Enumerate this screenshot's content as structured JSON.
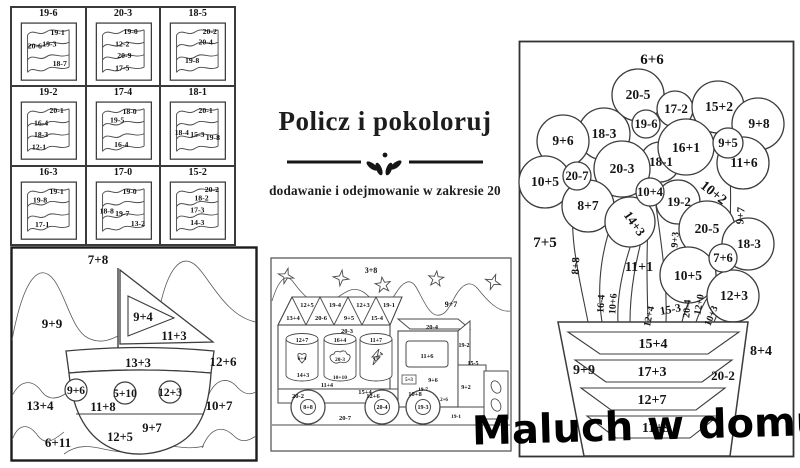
{
  "title_block": {
    "title": "Policz i pokoloruj",
    "subtitle": "dodawanie i odejmowanie w zakresie 20"
  },
  "watermark": {
    "text": "Maluch w domu"
  },
  "colors": {
    "ink": "#141414",
    "line": "#474747",
    "background": "#ffffff"
  },
  "flags_grid": {
    "cells": [
      {
        "header": "19-6",
        "labels": [
          {
            "t": "19-1",
            "x": 44,
            "y": 13
          },
          {
            "t": "20-6",
            "x": 22,
            "y": 26
          },
          {
            "t": "19-3",
            "x": 36,
            "y": 24
          },
          {
            "t": "18-7",
            "x": 46,
            "y": 43
          }
        ]
      },
      {
        "header": "20-3",
        "labels": [
          {
            "t": "19-0",
            "x": 42,
            "y": 12
          },
          {
            "t": "12-2",
            "x": 34,
            "y": 24
          },
          {
            "t": "20-9",
            "x": 36,
            "y": 35
          },
          {
            "t": "17-5",
            "x": 34,
            "y": 47
          }
        ]
      },
      {
        "header": "18-5",
        "labels": [
          {
            "t": "20-2",
            "x": 47,
            "y": 12
          },
          {
            "t": "20-4",
            "x": 43,
            "y": 22
          },
          {
            "t": "19-8",
            "x": 30,
            "y": 40
          }
        ]
      },
      {
        "header": "19-2",
        "labels": [
          {
            "t": "20-1",
            "x": 43,
            "y": 12
          },
          {
            "t": "16-4",
            "x": 28,
            "y": 24
          },
          {
            "t": "18-3",
            "x": 28,
            "y": 35
          },
          {
            "t": "12-1",
            "x": 26,
            "y": 47
          }
        ]
      },
      {
        "header": "17-4",
        "labels": [
          {
            "t": "18-0",
            "x": 41,
            "y": 13
          },
          {
            "t": "19-5",
            "x": 29,
            "y": 21
          },
          {
            "t": "16-4",
            "x": 33,
            "y": 45
          }
        ]
      },
      {
        "header": "18-1",
        "labels": [
          {
            "t": "20-1",
            "x": 43,
            "y": 12
          },
          {
            "t": "18-4",
            "x": 20,
            "y": 33
          },
          {
            "t": "15-3",
            "x": 35,
            "y": 35
          },
          {
            "t": "19-8",
            "x": 50,
            "y": 38
          }
        ]
      },
      {
        "header": "16-3",
        "labels": [
          {
            "t": "19-1",
            "x": 43,
            "y": 13
          },
          {
            "t": "19-8",
            "x": 27,
            "y": 21
          },
          {
            "t": "17-1",
            "x": 29,
            "y": 45
          }
        ]
      },
      {
        "header": "17-0",
        "labels": [
          {
            "t": "19-0",
            "x": 41,
            "y": 13
          },
          {
            "t": "18-8",
            "x": 19,
            "y": 32
          },
          {
            "t": "19-7",
            "x": 34,
            "y": 34
          },
          {
            "t": "13-2",
            "x": 49,
            "y": 44
          }
        ]
      },
      {
        "header": "15-2",
        "labels": [
          {
            "t": "20-2",
            "x": 49,
            "y": 11
          },
          {
            "t": "18-2",
            "x": 39,
            "y": 19
          },
          {
            "t": "17-3",
            "x": 35,
            "y": 31
          },
          {
            "t": "14-3",
            "x": 35,
            "y": 43
          }
        ]
      }
    ]
  },
  "boat": {
    "labels": [
      {
        "t": "7+8",
        "x": 88,
        "y": 18,
        "s": 13
      },
      {
        "t": "9+9",
        "x": 42,
        "y": 82,
        "s": 13
      },
      {
        "t": "9+4",
        "x": 133,
        "y": 75,
        "s": 12.5
      },
      {
        "t": "11+3",
        "x": 164,
        "y": 94,
        "s": 12.5
      },
      {
        "t": "12+6",
        "x": 213,
        "y": 120,
        "s": 13
      },
      {
        "t": "13+3",
        "x": 128,
        "y": 121,
        "s": 12.5
      },
      {
        "t": "9+6",
        "x": 66,
        "y": 148,
        "s": 11.5
      },
      {
        "t": "5+10",
        "x": 115,
        "y": 151,
        "s": 11.5
      },
      {
        "t": "12+3",
        "x": 160,
        "y": 150,
        "s": 11.5
      },
      {
        "t": "13+4",
        "x": 30,
        "y": 164,
        "s": 13
      },
      {
        "t": "10+7",
        "x": 209,
        "y": 164,
        "s": 13
      },
      {
        "t": "11+8",
        "x": 93,
        "y": 165,
        "s": 12.5
      },
      {
        "t": "9+7",
        "x": 142,
        "y": 186,
        "s": 12.5
      },
      {
        "t": "12+5",
        "x": 110,
        "y": 195,
        "s": 12.5
      },
      {
        "t": "6+11",
        "x": 48,
        "y": 201,
        "s": 13
      }
    ]
  },
  "truck": {
    "labels": [
      {
        "t": "3+8",
        "x": 101,
        "y": 16,
        "s": 8
      },
      {
        "t": "9+7",
        "x": 181,
        "y": 50,
        "s": 8
      },
      {
        "t": "13+4",
        "x": 23,
        "y": 63,
        "s": 6.5
      },
      {
        "t": "20-6",
        "x": 51,
        "y": 63,
        "s": 6.5
      },
      {
        "t": "9+5",
        "x": 79,
        "y": 63,
        "s": 6.5
      },
      {
        "t": "15-4",
        "x": 107,
        "y": 63,
        "s": 6.5
      },
      {
        "t": "12+5",
        "x": 37,
        "y": 50,
        "s": 6.5
      },
      {
        "t": "19-4",
        "x": 65,
        "y": 50,
        "s": 6.5
      },
      {
        "t": "12+3",
        "x": 93,
        "y": 50,
        "s": 6.5
      },
      {
        "t": "19-1",
        "x": 119,
        "y": 50,
        "s": 6.5
      },
      {
        "t": "20-3",
        "x": 77,
        "y": 76,
        "s": 6.5
      },
      {
        "t": "12+7",
        "x": 32,
        "y": 85,
        "s": 6
      },
      {
        "t": "16+4",
        "x": 70,
        "y": 85,
        "s": 6
      },
      {
        "t": "11+7",
        "x": 106,
        "y": 85,
        "s": 6
      },
      {
        "t": "6+4",
        "x": 32,
        "y": 103,
        "s": 5.5
      },
      {
        "t": "20-3",
        "x": 70,
        "y": 104,
        "s": 5.5
      },
      {
        "t": "12+4",
        "x": 109,
        "y": 101,
        "s": 5.5,
        "r": -40
      },
      {
        "t": "14+3",
        "x": 33,
        "y": 120,
        "s": 6
      },
      {
        "t": "10+10",
        "x": 70,
        "y": 122,
        "s": 5.5
      },
      {
        "t": "15+4",
        "x": 95,
        "y": 137,
        "s": 6.5
      },
      {
        "t": "11+4",
        "x": 57,
        "y": 130,
        "s": 6
      },
      {
        "t": "20-2",
        "x": 28,
        "y": 141,
        "s": 6.5
      },
      {
        "t": "8+8",
        "x": 38,
        "y": 152,
        "s": 6
      },
      {
        "t": "12+6",
        "x": 103,
        "y": 141,
        "s": 6.5
      },
      {
        "t": "20-4",
        "x": 112,
        "y": 152,
        "s": 6
      },
      {
        "t": "20-7",
        "x": 75,
        "y": 163,
        "s": 6.5
      },
      {
        "t": "10+8",
        "x": 145,
        "y": 139,
        "s": 6.5
      },
      {
        "t": "19-3",
        "x": 153,
        "y": 152,
        "s": 6
      },
      {
        "t": "20-4",
        "x": 162,
        "y": 72,
        "s": 6.5
      },
      {
        "t": "11+6",
        "x": 157,
        "y": 101,
        "s": 6.5
      },
      {
        "t": "5+3",
        "x": 139,
        "y": 124,
        "s": 5
      },
      {
        "t": "9+6",
        "x": 163,
        "y": 125,
        "s": 6
      },
      {
        "t": "19-7",
        "x": 153,
        "y": 134,
        "s": 5.5
      },
      {
        "t": "19-2",
        "x": 194,
        "y": 90,
        "s": 6
      },
      {
        "t": "15-5",
        "x": 203,
        "y": 108,
        "s": 6
      },
      {
        "t": "9+2",
        "x": 196,
        "y": 132,
        "s": 6
      },
      {
        "t": "2+6",
        "x": 174,
        "y": 144,
        "s": 5
      },
      {
        "t": "19-1",
        "x": 186,
        "y": 161,
        "s": 5.5
      }
    ]
  },
  "flower": {
    "labels": [
      {
        "t": "6+6",
        "x": 134,
        "y": 24,
        "s": 15
      },
      {
        "t": "20-5",
        "x": 120,
        "y": 59,
        "s": 13.5
      },
      {
        "t": "17-2",
        "x": 158,
        "y": 73,
        "s": 13
      },
      {
        "t": "15+2",
        "x": 201,
        "y": 71,
        "s": 13.5
      },
      {
        "t": "9+8",
        "x": 241,
        "y": 88,
        "s": 13.5
      },
      {
        "t": "18-3",
        "x": 86,
        "y": 98,
        "s": 13.5
      },
      {
        "t": "19-6",
        "x": 128,
        "y": 88,
        "s": 12.5
      },
      {
        "t": "16+1",
        "x": 168,
        "y": 112,
        "s": 13.5
      },
      {
        "t": "9+5",
        "x": 210,
        "y": 107,
        "s": 12.5
      },
      {
        "t": "9+6",
        "x": 45,
        "y": 105,
        "s": 13.5
      },
      {
        "t": "11+6",
        "x": 226,
        "y": 127,
        "s": 13.5
      },
      {
        "t": "18-1",
        "x": 143,
        "y": 126,
        "s": 13
      },
      {
        "t": "20-7",
        "x": 59,
        "y": 140,
        "s": 12.5
      },
      {
        "t": "20-3",
        "x": 104,
        "y": 133,
        "s": 13.5
      },
      {
        "t": "10+5",
        "x": 27,
        "y": 146,
        "s": 13.5
      },
      {
        "t": "10+4",
        "x": 132,
        "y": 156,
        "s": 12.5
      },
      {
        "t": "19-2",
        "x": 161,
        "y": 166,
        "s": 13
      },
      {
        "t": "10+2",
        "x": 193,
        "y": 156,
        "s": 14,
        "r": 38
      },
      {
        "t": "8+7",
        "x": 70,
        "y": 170,
        "s": 13.5
      },
      {
        "t": "14+3",
        "x": 113,
        "y": 186,
        "s": 13,
        "r": 55
      },
      {
        "t": "9+7",
        "x": 226,
        "y": 176,
        "s": 11,
        "r": -85
      },
      {
        "t": "20-5",
        "x": 189,
        "y": 193,
        "s": 13.5
      },
      {
        "t": "7+5",
        "x": 27,
        "y": 207,
        "s": 15
      },
      {
        "t": "18-3",
        "x": 231,
        "y": 208,
        "s": 13
      },
      {
        "t": "7+6",
        "x": 205,
        "y": 222,
        "s": 12.5
      },
      {
        "t": "11+1",
        "x": 121,
        "y": 231,
        "s": 14
      },
      {
        "t": "8+8",
        "x": 61,
        "y": 226,
        "s": 11,
        "r": -88
      },
      {
        "t": "10+5",
        "x": 170,
        "y": 240,
        "s": 13.5
      },
      {
        "t": "12+3",
        "x": 216,
        "y": 260,
        "s": 13.5
      },
      {
        "t": "9+3",
        "x": 160,
        "y": 200,
        "s": 10,
        "r": -85
      },
      {
        "t": "16-4",
        "x": 86,
        "y": 264,
        "s": 10,
        "r": -86
      },
      {
        "t": "10+6",
        "x": 98,
        "y": 264,
        "s": 10,
        "r": -86
      },
      {
        "t": "12+4",
        "x": 134,
        "y": 277,
        "s": 10,
        "r": -78
      },
      {
        "t": "15-3",
        "x": 153,
        "y": 273,
        "s": 11.5,
        "r": -10
      },
      {
        "t": "20-4",
        "x": 172,
        "y": 269,
        "s": 10,
        "r": -85
      },
      {
        "t": "12+0",
        "x": 184,
        "y": 265,
        "s": 10,
        "r": -80
      },
      {
        "t": "10+3",
        "x": 196,
        "y": 277,
        "s": 10,
        "r": -68
      },
      {
        "t": "15+4",
        "x": 135,
        "y": 308,
        "s": 14
      },
      {
        "t": "9+9",
        "x": 66,
        "y": 334,
        "s": 14
      },
      {
        "t": "8+4",
        "x": 243,
        "y": 315,
        "s": 14
      },
      {
        "t": "20-2",
        "x": 205,
        "y": 340,
        "s": 13
      },
      {
        "t": "17+3",
        "x": 134,
        "y": 336,
        "s": 14
      },
      {
        "t": "12+7",
        "x": 134,
        "y": 364,
        "s": 14
      },
      {
        "t": "11+9",
        "x": 138,
        "y": 392,
        "s": 14
      }
    ]
  }
}
